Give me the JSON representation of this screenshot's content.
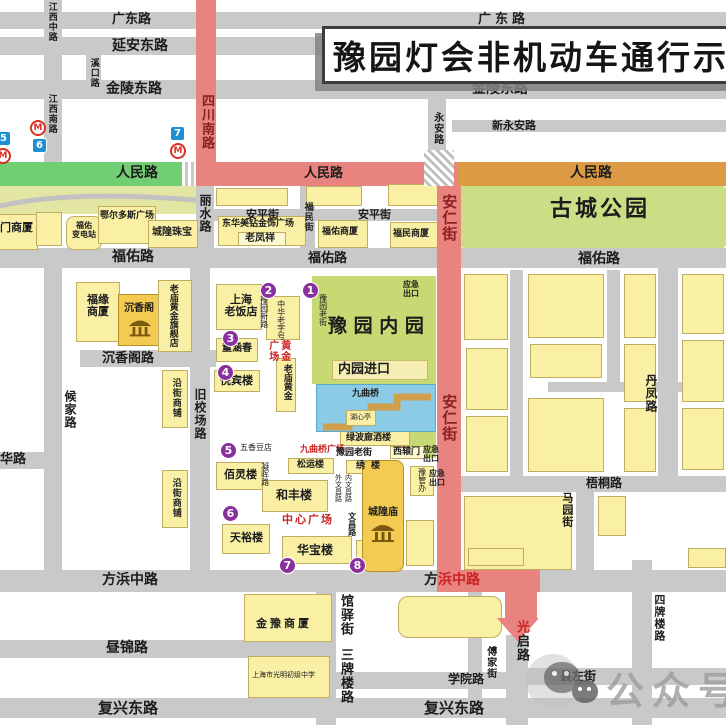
{
  "banner": {
    "title": "豫园灯会非机动车通行示"
  },
  "watermark": {
    "label": "公众号",
    "dot": "·"
  },
  "roads": {
    "guangdong": "广东路",
    "yanan_dong": "延安东路",
    "jinling_dong": "金陵东路",
    "xin_yongan": "新永安路",
    "renmin": "人民路",
    "anping": "安平街",
    "fuyou": "福佑路",
    "chenxiangge_rd": "沉香阁路",
    "hua": "华路",
    "wutong": "梧桐路",
    "fangbin_full": "方浜中路",
    "fangbin_black": "方",
    "fangbin_red": "浜中路",
    "zhoujin": "昼锦路",
    "xueyuan": "学院路",
    "xianzuo": "县左街",
    "fuxing_dong": "复兴东路",
    "jiangxi_zhong": "江西中路",
    "xikou": "溪口路",
    "jiangxi_nan": "江西南路",
    "sichuan_nan": "四川南路",
    "lishui": "丽水路",
    "yongan": "永安路",
    "anren": "安仁街",
    "fumin": "福民街",
    "houjia": "候家路",
    "jiuxiaochang": "旧校场路",
    "mayuan": "马园街",
    "danfeng": "丹凤路",
    "guanyi": "馆驿街",
    "sanpailou": "三牌楼路",
    "guangqi_first": "光",
    "guangqi_rest": "启路",
    "sipailou": "四牌楼路",
    "fujia": "傅家街",
    "yuyuan_xin": "豫园新路",
    "yuyuan_lao": "豫园老街",
    "wenchang": "文昌路",
    "wai_wenchang": "外文昌路",
    "nei_wenchang": "内文昌路",
    "ninghui": "凝晖路"
  },
  "areas": {
    "gucheng_park": "古城公园",
    "neiyuan": "豫 园 内 园",
    "neiyuan_entrance": "内园进口"
  },
  "places": {
    "men_shangsha": "门商厦",
    "fuyou_substation": "福佑\n变电站",
    "eerduosi": "鄂尔多斯广场",
    "chenghuang_zhubao": "城隍珠宝",
    "donghua_meizuan": "东华美钻金饰广场",
    "laofengxiang": "老凤祥",
    "fuyou_shangsha": "福佑商厦",
    "fumin_shangsha": "福民商厦",
    "fuyuan_shangsha": "福缘\n商厦",
    "chenxiangge": "沉香阁",
    "laomiao_flagship": "老庙黄金旗舰店",
    "yanjie_shangpu": "沿街商铺",
    "shanghai_laofandian": "上海\n老饭店",
    "tonghanchun": "童涵春",
    "yuebinlou": "悦宾楼",
    "bailinglou": "佰灵楼",
    "hefenglou": "和丰楼",
    "tianyulou": "天裕楼",
    "huabaolou": "华宝楼",
    "songyunlou": "松运楼",
    "laomiao_huangjin": "老庙黄金",
    "zhonghua_laozihao": "中华老字号",
    "wuxiangdou": "五香豆店",
    "lvbolang": "绿波廊酒楼",
    "xiyuanmen": "西辕门",
    "xiulou": "绣楼",
    "chenghuangmiao": "城隍庙",
    "huxinting": "湖心亭",
    "jiuqu_bridge": "九曲桥",
    "yuguanban": "豫管办",
    "jinyu_shangsha": "金豫商厦",
    "guangming_school": "上海市光明初级中学"
  },
  "highlights": {
    "huangjin_a": "黄金",
    "huangjin_b": "广场",
    "jiuqu_plaza": "九曲桥广场",
    "center_plaza": "中心广场",
    "emergency": "应急\n出口"
  },
  "markers": {
    "points": [
      "1",
      "2",
      "3",
      "4",
      "5",
      "6",
      "7",
      "8"
    ],
    "metro": [
      "5",
      "6",
      "7"
    ],
    "metro_logo": "M"
  }
}
